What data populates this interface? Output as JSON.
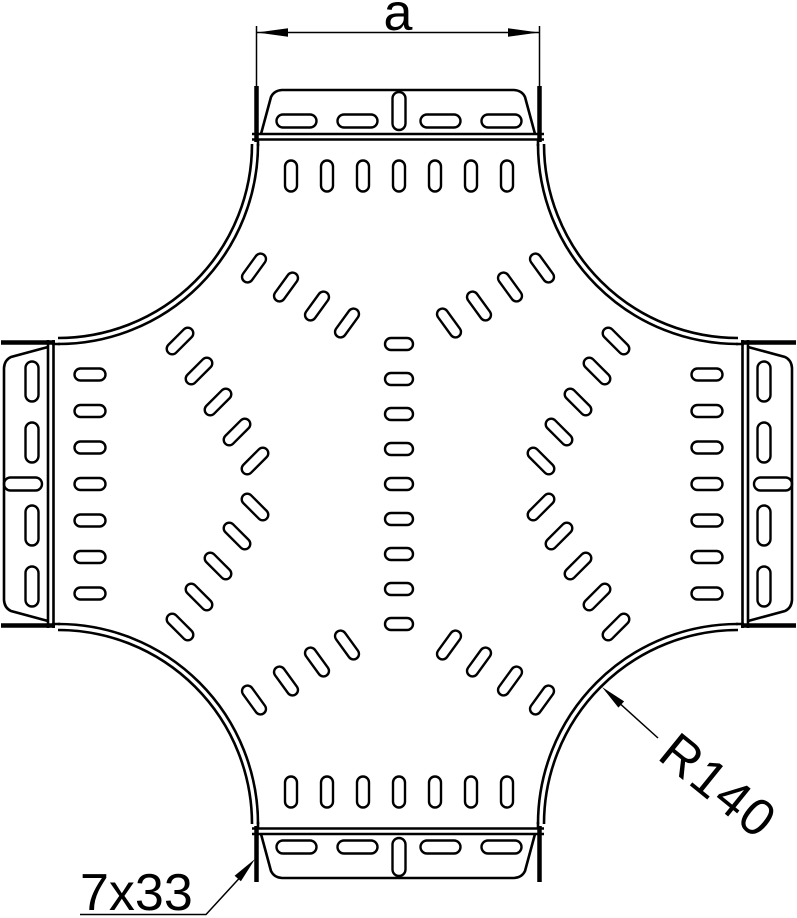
{
  "canvas": {
    "background": "#ffffff",
    "ink": "#000000"
  },
  "annotations": {
    "width_label": "a",
    "radius_label": "R140",
    "slot_size_label": "7x33"
  }
}
